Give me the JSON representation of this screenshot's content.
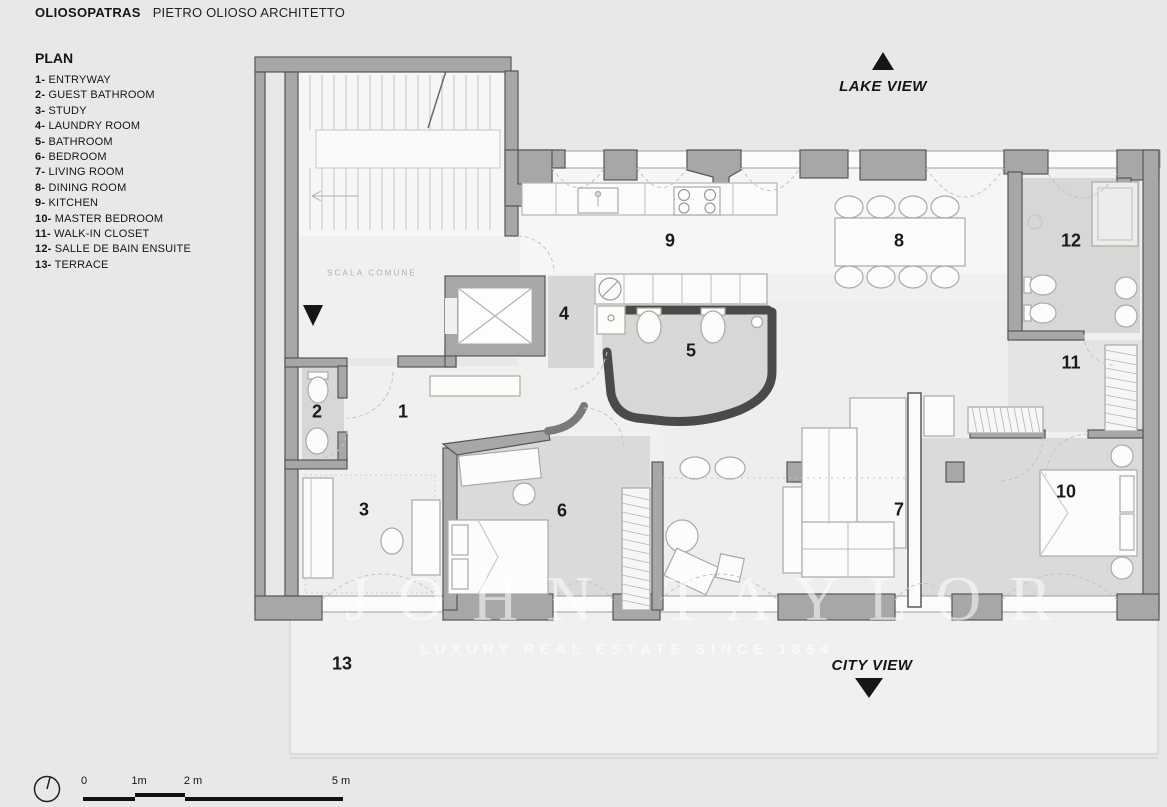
{
  "header": {
    "brand": "OLIOSOPATRAS",
    "studio": "PIETRO OLIOSO ARCHITETTO"
  },
  "legend": {
    "title": "PLAN",
    "items": [
      {
        "num": "1-",
        "label": "ENTRYWAY"
      },
      {
        "num": "2-",
        "label": "GUEST BATHROOM"
      },
      {
        "num": "3-",
        "label": "STUDY"
      },
      {
        "num": "4-",
        "label": "LAUNDRY ROOM"
      },
      {
        "num": "5-",
        "label": "BATHROOM"
      },
      {
        "num": "6-",
        "label": "BEDROOM"
      },
      {
        "num": "7-",
        "label": "LIVING ROOM"
      },
      {
        "num": "8-",
        "label": "DINING ROOM"
      },
      {
        "num": "9-",
        "label": "KITCHEN"
      },
      {
        "num": "10-",
        "label": "MASTER BEDROOM"
      },
      {
        "num": "11-",
        "label": "WALK-IN CLOSET"
      },
      {
        "num": "12-",
        "label": "SALLE DE BAIN ENSUITE"
      },
      {
        "num": "13-",
        "label": "TERRACE"
      }
    ]
  },
  "plan": {
    "stair_label": "SCALA COMUNE",
    "rooms": [
      {
        "num": "1",
        "x": 403,
        "y": 412
      },
      {
        "num": "2",
        "x": 317,
        "y": 412
      },
      {
        "num": "3",
        "x": 364,
        "y": 510
      },
      {
        "num": "4",
        "x": 564,
        "y": 314
      },
      {
        "num": "5",
        "x": 691,
        "y": 351
      },
      {
        "num": "6",
        "x": 562,
        "y": 511
      },
      {
        "num": "7",
        "x": 899,
        "y": 510
      },
      {
        "num": "8",
        "x": 899,
        "y": 241
      },
      {
        "num": "9",
        "x": 670,
        "y": 241
      },
      {
        "num": "10",
        "x": 1066,
        "y": 492
      },
      {
        "num": "11",
        "x": 1071,
        "y": 363
      },
      {
        "num": "12",
        "x": 1071,
        "y": 241
      },
      {
        "num": "13",
        "x": 342,
        "y": 664
      }
    ]
  },
  "views": {
    "lake": "LAKE VIEW",
    "city": "CITY VIEW"
  },
  "watermark": {
    "title": "JOHN TAYLOR",
    "subtitle": "LUXURY REAL ESTATE SINCE 1864"
  },
  "scalebar": {
    "labels": [
      {
        "t": "0",
        "x": 84
      },
      {
        "t": "1m",
        "x": 139
      },
      {
        "t": "2 m",
        "x": 193
      },
      {
        "t": "5 m",
        "x": 341
      }
    ]
  },
  "colors": {
    "wall": "#a7a7a5",
    "wall_outline": "#565656",
    "floor_gray": "#d7d7d5",
    "accent_black": "#161616"
  }
}
